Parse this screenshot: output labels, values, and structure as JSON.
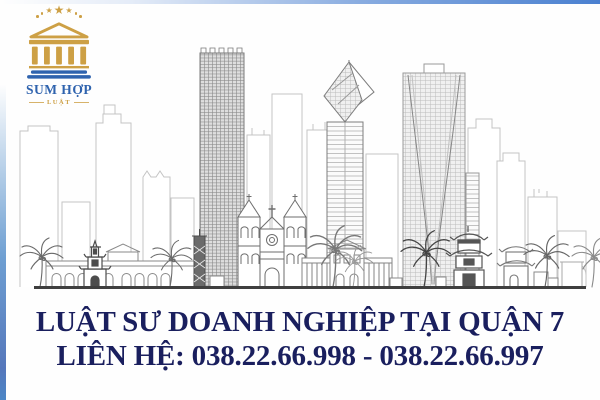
{
  "banner": {
    "headline": "LUẬT SƯ DOANH NGHIỆP TẠI QUẬN 7",
    "contact_line": "LIÊN HỆ: 038.22.66.998 - 038.22.66.997",
    "phone_1": "038.22.66.998",
    "phone_2": "038.22.66.997"
  },
  "logo": {
    "org_name": "SUM HỢP",
    "org_type": "LUẬT",
    "icon": "courthouse-temple-icon",
    "stars": "stars-arc-icon"
  },
  "artwork": {
    "illustration": "city-skyline-line-art",
    "landmarks": [
      "cathedral-twin-towers",
      "crystal-top-tower",
      "grid-facade-tower",
      "hatched-highrise",
      "turtle-tower",
      "pagoda-gates",
      "palm-trees"
    ]
  },
  "colors": {
    "background": "#fefefe",
    "edge_blue": "#4a80d0",
    "logo_gold": "#cda045",
    "logo_blue": "#2f63ae",
    "banner_text": "#1a1f5e",
    "skyline_ink": "#5a5a5a",
    "skyline_light": "#c4c4c4"
  }
}
